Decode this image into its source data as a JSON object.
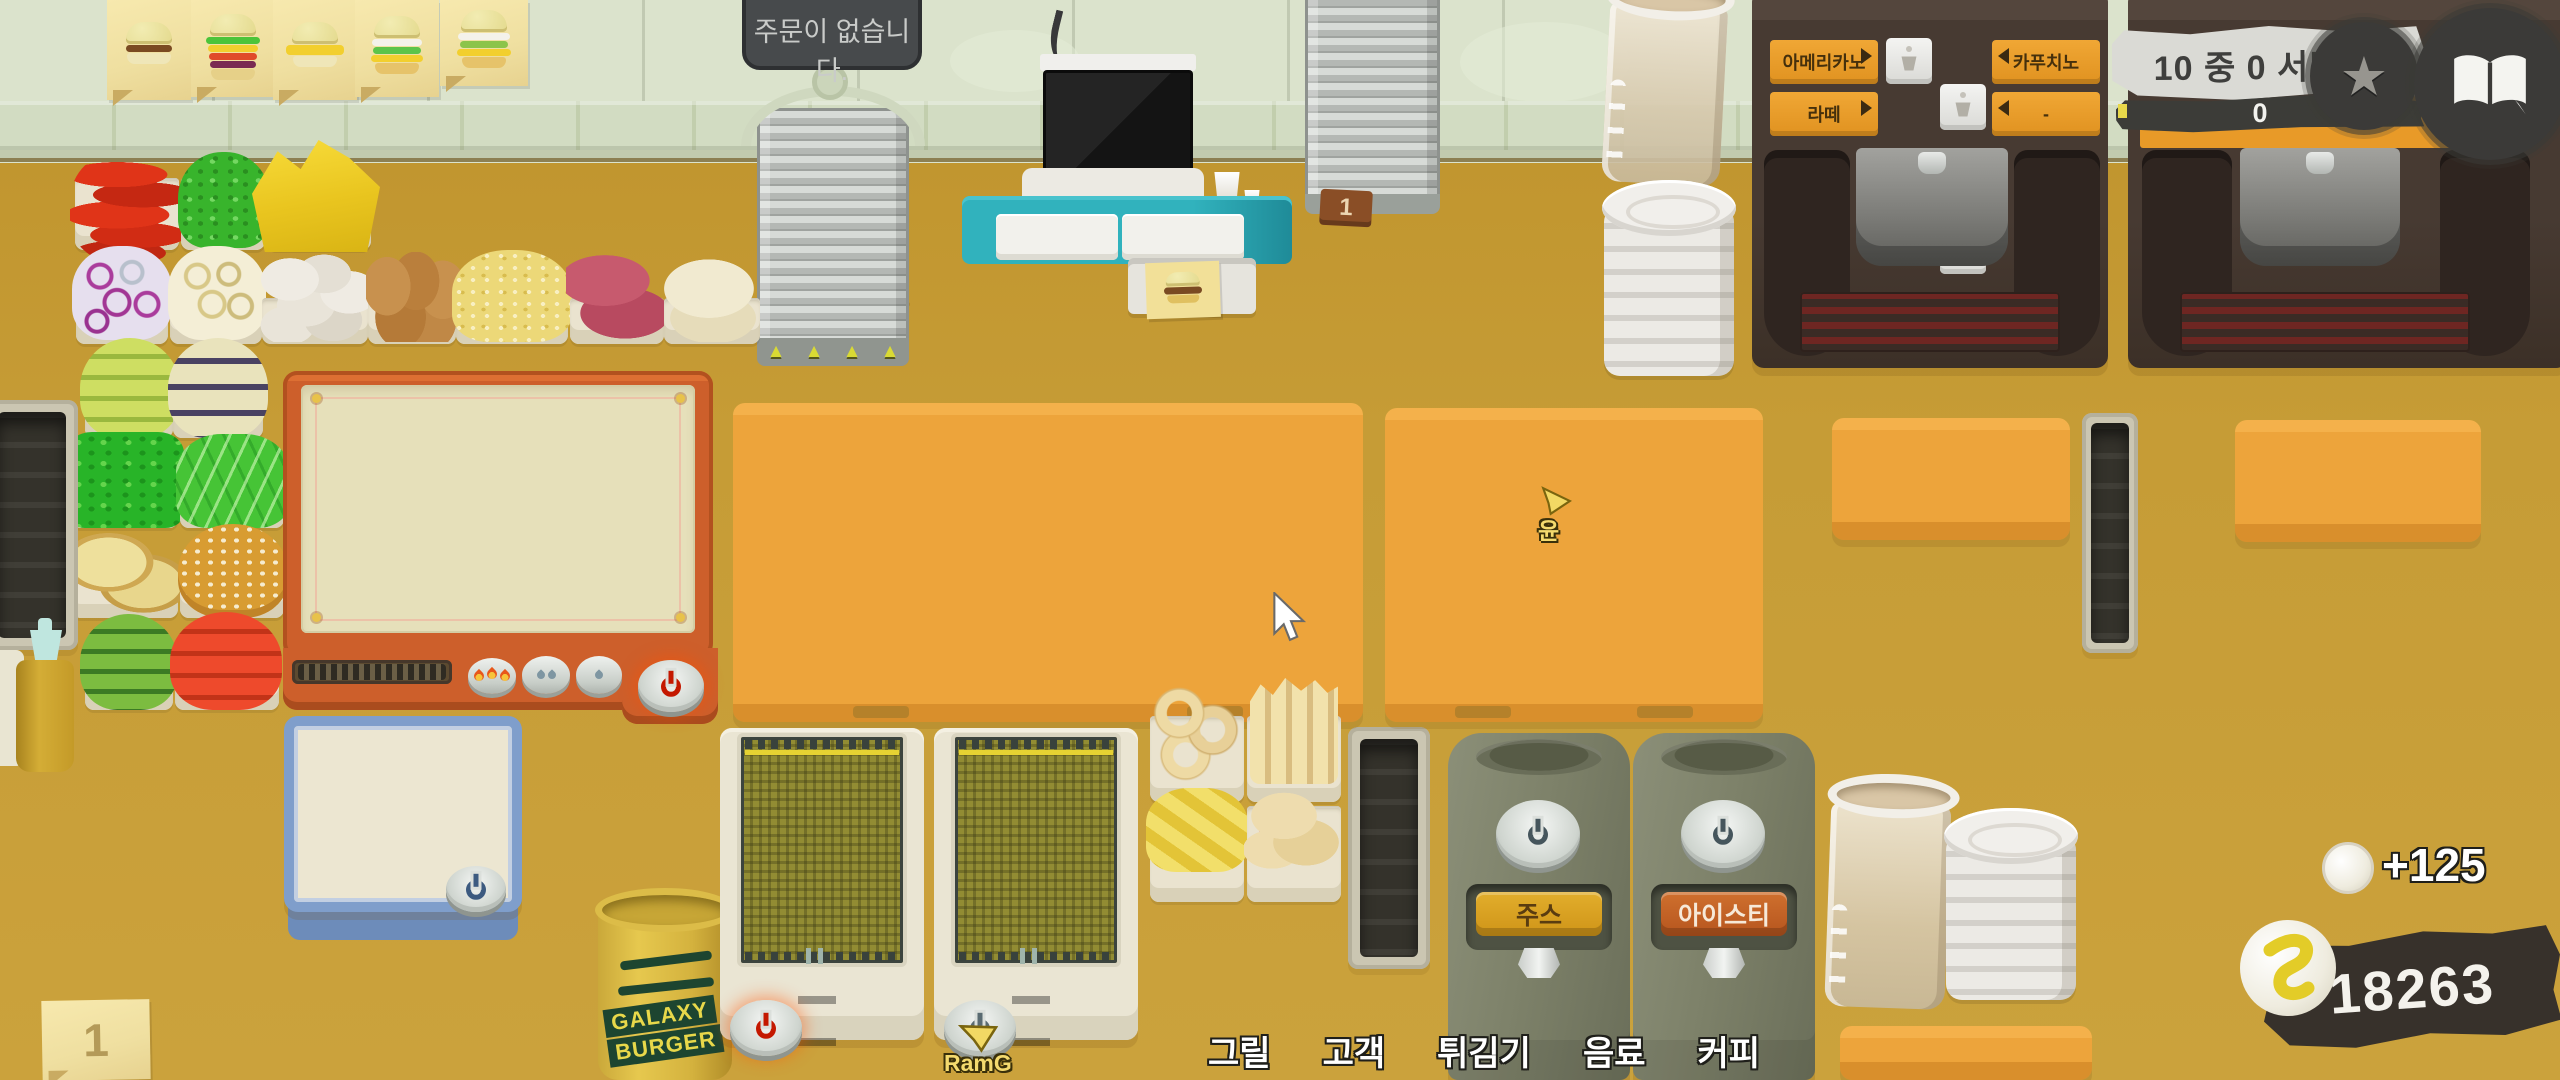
{
  "orders_panel": {
    "message": "주문이 없습니다."
  },
  "serving_board": {
    "label": "10 중 0 서빙함.",
    "progress": "0"
  },
  "coffee_machine": {
    "americano": "아메리카노",
    "cappuccino": "카푸치노",
    "latte": "라떼",
    "empty_slot": "-"
  },
  "drink_machines": {
    "juice": "주스",
    "iced_tea": "아이스티"
  },
  "shutter": {
    "tag": "1"
  },
  "note": {
    "count": "1"
  },
  "bucket": {
    "line1": "GALAXY",
    "line2": "BURGER"
  },
  "nav": {
    "items": [
      {
        "label": "그릴"
      },
      {
        "label": "고객"
      },
      {
        "label": "튀김기"
      },
      {
        "label": "음료"
      },
      {
        "label": "커피"
      }
    ]
  },
  "money": {
    "balance": "18263",
    "gain": "+125"
  },
  "players": {
    "fryer_cursor": "RamG",
    "counter_cursor": "윤"
  },
  "colors": {
    "counter_orange": "#eda43b",
    "coffee_label_orange": "#e89a28",
    "juice_amber": "#d79c22",
    "iced_tea_orange": "#c2602a",
    "coin_yellow": "#e3cc28"
  }
}
